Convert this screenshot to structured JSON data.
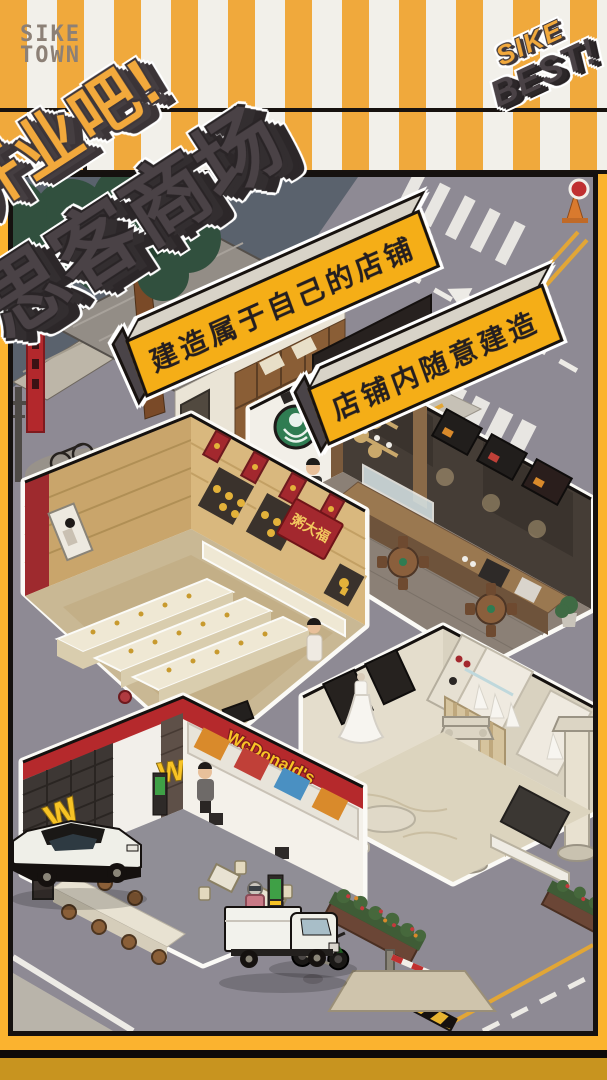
{
  "window": {
    "width": 607,
    "height": 1080
  },
  "branding": {
    "logo": {
      "line1": "SIKE",
      "line2": "TOWN"
    },
    "badge": {
      "line1": "SIKE",
      "line2": "BEST!"
    }
  },
  "title": {
    "line1": "开业吧!",
    "line2": "思客商场"
  },
  "banners": {
    "first": "建造属于自己的店铺",
    "second": "店铺内随意建造"
  },
  "shops": {
    "gold": {
      "sign": "粥大福",
      "type": "jewelry-shop"
    },
    "burger": {
      "sign": "WcDonald's",
      "logo": "W",
      "type": "fast-food-shop"
    },
    "coffee": {
      "sign_icon": "green-mermaid-disc-icon",
      "type": "coffee-shop"
    },
    "wedding": {
      "type": "wedding-dress-shop"
    }
  },
  "icons": {
    "coffee_sign": "green-mermaid-disc-icon",
    "burger_logo": "golden-arches-w-icon",
    "traffic_cone": "traffic-cone-icon",
    "road_arrow": "road-arrow-icon"
  },
  "colors": {
    "stripe_yellow": "#F0A93C",
    "accent_yellow": "#F5AE17",
    "bright_edge_yellow": "#FBB32F",
    "deep_gold_footer": "#C8941F",
    "ink": "#15110F",
    "title_yellow": "#F2A93C",
    "title_dark": "#4A4246",
    "brand_red": "#B5292C",
    "gold_sign_red": "#A3282E",
    "coffee_green": "#2F7C52",
    "road_gray": "#8E8A94",
    "backdrop_slate": "#5A626D"
  }
}
